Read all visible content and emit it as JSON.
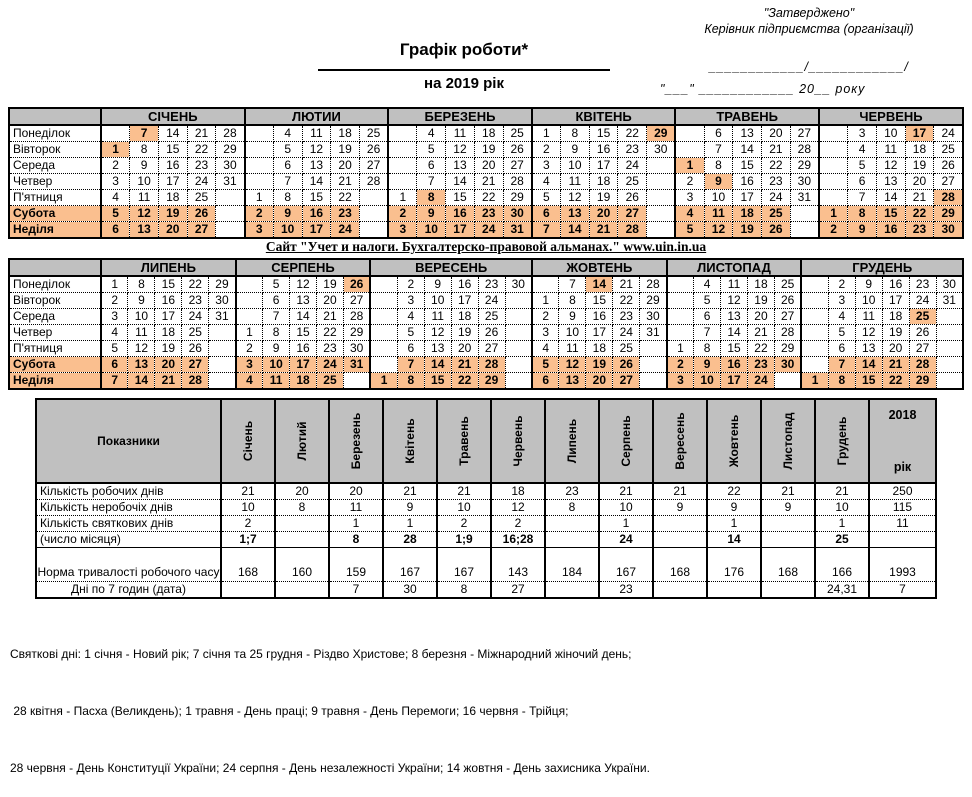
{
  "colors": {
    "header_gray": "#C0C0C0",
    "holiday_highlight": "#FABF8F"
  },
  "approval": {
    "line1": "\"Затверджено\"",
    "line2": "Керівник підприємства (організації)",
    "line3": "____________/____________/",
    "line4": "\"___\" ____________  20__ року"
  },
  "title": {
    "main": "Графік роботи*",
    "sub": "на 2019 рік"
  },
  "site_banner": "Сайт \"Учет и налоги. Бухгалтерско-правовой альманах.\" www.uin.in.ua",
  "calendar": {
    "day_labels": [
      "Понеділок",
      "Вівторок",
      "Середа",
      "Четвер",
      "П'ятниця",
      "Субота",
      "Неділя"
    ],
    "half1": {
      "months": [
        {
          "name": "СІЧЕНЬ",
          "holidays": [
            1,
            7
          ],
          "grid": [
            [
              "",
              "7",
              "14",
              "21",
              "28"
            ],
            [
              "1",
              "8",
              "15",
              "22",
              "29"
            ],
            [
              "2",
              "9",
              "16",
              "23",
              "30"
            ],
            [
              "3",
              "10",
              "17",
              "24",
              "31"
            ],
            [
              "4",
              "11",
              "18",
              "25",
              ""
            ],
            [
              "5",
              "12",
              "19",
              "26",
              ""
            ],
            [
              "6",
              "13",
              "20",
              "27",
              ""
            ]
          ]
        },
        {
          "name": "ЛЮТИИ",
          "holidays": [],
          "grid": [
            [
              "",
              "4",
              "11",
              "18",
              "25"
            ],
            [
              "",
              "5",
              "12",
              "19",
              "26"
            ],
            [
              "",
              "6",
              "13",
              "20",
              "27"
            ],
            [
              "",
              "7",
              "14",
              "21",
              "28"
            ],
            [
              "1",
              "8",
              "15",
              "22",
              ""
            ],
            [
              "2",
              "9",
              "16",
              "23",
              ""
            ],
            [
              "3",
              "10",
              "17",
              "24",
              ""
            ]
          ]
        },
        {
          "name": "БЕРЕЗЕНЬ",
          "holidays": [
            8
          ],
          "grid": [
            [
              "",
              "4",
              "11",
              "18",
              "25"
            ],
            [
              "",
              "5",
              "12",
              "19",
              "26"
            ],
            [
              "",
              "6",
              "13",
              "20",
              "27"
            ],
            [
              "",
              "7",
              "14",
              "21",
              "28"
            ],
            [
              "1",
              "8",
              "15",
              "22",
              "29"
            ],
            [
              "2",
              "9",
              "16",
              "23",
              "30"
            ],
            [
              "3",
              "10",
              "17",
              "24",
              "31"
            ]
          ]
        },
        {
          "name": "КВІТЕНЬ",
          "holidays": [
            29
          ],
          "grid": [
            [
              "1",
              "8",
              "15",
              "22",
              "29"
            ],
            [
              "2",
              "9",
              "16",
              "23",
              "30"
            ],
            [
              "3",
              "10",
              "17",
              "24",
              ""
            ],
            [
              "4",
              "11",
              "18",
              "25",
              ""
            ],
            [
              "5",
              "12",
              "19",
              "26",
              ""
            ],
            [
              "6",
              "13",
              "20",
              "27",
              ""
            ],
            [
              "7",
              "14",
              "21",
              "28",
              ""
            ]
          ]
        },
        {
          "name": "ТРАВЕНЬ",
          "holidays": [
            1,
            9
          ],
          "grid": [
            [
              "",
              "6",
              "13",
              "20",
              "27"
            ],
            [
              "",
              "7",
              "14",
              "21",
              "28"
            ],
            [
              "1",
              "8",
              "15",
              "22",
              "29"
            ],
            [
              "2",
              "9",
              "16",
              "23",
              "30"
            ],
            [
              "3",
              "10",
              "17",
              "24",
              "31"
            ],
            [
              "4",
              "11",
              "18",
              "25",
              ""
            ],
            [
              "5",
              "12",
              "19",
              "26",
              ""
            ]
          ]
        },
        {
          "name": "ЧЕРВЕНЬ",
          "holidays": [
            17,
            28
          ],
          "grid": [
            [
              "",
              "3",
              "10",
              "17",
              "24"
            ],
            [
              "",
              "4",
              "11",
              "18",
              "25"
            ],
            [
              "",
              "5",
              "12",
              "19",
              "26"
            ],
            [
              "",
              "6",
              "13",
              "20",
              "27"
            ],
            [
              "",
              "7",
              "14",
              "21",
              "28"
            ],
            [
              "1",
              "8",
              "15",
              "22",
              "29"
            ],
            [
              "2",
              "9",
              "16",
              "23",
              "30"
            ]
          ]
        }
      ]
    },
    "half2": {
      "months": [
        {
          "name": "ЛИПЕНЬ",
          "holidays": [],
          "grid": [
            [
              "1",
              "8",
              "15",
              "22",
              "29"
            ],
            [
              "2",
              "9",
              "16",
              "23",
              "30"
            ],
            [
              "3",
              "10",
              "17",
              "24",
              "31"
            ],
            [
              "4",
              "11",
              "18",
              "25",
              ""
            ],
            [
              "5",
              "12",
              "19",
              "26",
              ""
            ],
            [
              "6",
              "13",
              "20",
              "27",
              ""
            ],
            [
              "7",
              "14",
              "21",
              "28",
              ""
            ]
          ]
        },
        {
          "name": "СЕРПЕНЬ",
          "holidays": [
            26
          ],
          "grid": [
            [
              "",
              "5",
              "12",
              "19",
              "26"
            ],
            [
              "",
              "6",
              "13",
              "20",
              "27"
            ],
            [
              "",
              "7",
              "14",
              "21",
              "28"
            ],
            [
              "1",
              "8",
              "15",
              "22",
              "29"
            ],
            [
              "2",
              "9",
              "16",
              "23",
              "30"
            ],
            [
              "3",
              "10",
              "17",
              "24",
              "31"
            ],
            [
              "4",
              "11",
              "18",
              "25",
              ""
            ]
          ]
        },
        {
          "name": "ВЕРЕСЕНЬ",
          "holidays": [],
          "grid": [
            [
              "",
              "2",
              "9",
              "16",
              "23",
              "30"
            ],
            [
              "",
              "3",
              "10",
              "17",
              "24",
              ""
            ],
            [
              "",
              "4",
              "11",
              "18",
              "25",
              ""
            ],
            [
              "",
              "5",
              "12",
              "19",
              "26",
              ""
            ],
            [
              "",
              "6",
              "13",
              "20",
              "27",
              ""
            ],
            [
              "",
              "7",
              "14",
              "21",
              "28",
              ""
            ],
            [
              "1",
              "8",
              "15",
              "22",
              "29",
              ""
            ]
          ]
        },
        {
          "name": "ЖОВТЕНЬ",
          "holidays": [
            14
          ],
          "grid": [
            [
              "",
              "7",
              "14",
              "21",
              "28"
            ],
            [
              "1",
              "8",
              "15",
              "22",
              "29"
            ],
            [
              "2",
              "9",
              "16",
              "23",
              "30"
            ],
            [
              "3",
              "10",
              "17",
              "24",
              "31"
            ],
            [
              "4",
              "11",
              "18",
              "25",
              ""
            ],
            [
              "5",
              "12",
              "19",
              "26",
              ""
            ],
            [
              "6",
              "13",
              "20",
              "27",
              ""
            ]
          ]
        },
        {
          "name": "ЛИСТОПАД",
          "holidays": [],
          "grid": [
            [
              "",
              "4",
              "11",
              "18",
              "25"
            ],
            [
              "",
              "5",
              "12",
              "19",
              "26"
            ],
            [
              "",
              "6",
              "13",
              "20",
              "27"
            ],
            [
              "",
              "7",
              "14",
              "21",
              "28"
            ],
            [
              "1",
              "8",
              "15",
              "22",
              "29"
            ],
            [
              "2",
              "9",
              "16",
              "23",
              "30"
            ],
            [
              "3",
              "10",
              "17",
              "24",
              ""
            ]
          ]
        },
        {
          "name": "ГРУДЕНЬ",
          "holidays": [
            25
          ],
          "grid": [
            [
              "",
              "2",
              "9",
              "16",
              "23",
              "30"
            ],
            [
              "",
              "3",
              "10",
              "17",
              "24",
              "31"
            ],
            [
              "",
              "4",
              "11",
              "18",
              "25",
              ""
            ],
            [
              "",
              "5",
              "12",
              "19",
              "26",
              ""
            ],
            [
              "",
              "6",
              "13",
              "20",
              "27",
              ""
            ],
            [
              "",
              "7",
              "14",
              "21",
              "28",
              ""
            ],
            [
              "1",
              "8",
              "15",
              "22",
              "29",
              ""
            ]
          ]
        }
      ]
    }
  },
  "summary": {
    "corner_label": "Показники",
    "month_headers": [
      "Січень",
      "Лютий",
      "Березень",
      "Квітень",
      "Травень",
      "Червень",
      "Липень",
      "Серпень",
      "Вересень",
      "Жовтень",
      "Листопад",
      "Грудень"
    ],
    "year_header": {
      "top": "2018",
      "bottom": "рік"
    },
    "rows": [
      {
        "label": "Кількість робочих днів",
        "label_align": "left",
        "bold_values": false,
        "values": [
          "21",
          "20",
          "20",
          "21",
          "21",
          "18",
          "23",
          "21",
          "21",
          "22",
          "21",
          "21",
          "250"
        ]
      },
      {
        "label": "Кількість неробочіх днів",
        "label_align": "left",
        "bold_values": false,
        "values": [
          "10",
          "8",
          "11",
          "9",
          "10",
          "12",
          "8",
          "10",
          "9",
          "9",
          "9",
          "10",
          "115"
        ]
      },
      {
        "label": "Кількість святкових днів",
        "label_align": "left",
        "bold_values": false,
        "values": [
          "2",
          "",
          "1",
          "1",
          "2",
          "2",
          "",
          "1",
          "",
          "1",
          "",
          "1",
          "11"
        ]
      },
      {
        "label": "(число місяця)",
        "label_align": "left",
        "bold_values": true,
        "values": [
          "1;7",
          "",
          "8",
          "28",
          "1;9",
          "16;28",
          "",
          "24",
          "",
          "14",
          "",
          "25",
          ""
        ]
      },
      {
        "label": "Норма тривалості  робочого часу",
        "label_align": "center",
        "bold_values": false,
        "values": [
          "168",
          "160",
          "159",
          "167",
          "167",
          "143",
          "184",
          "167",
          "168",
          "176",
          "168",
          "166",
          "1993"
        ]
      },
      {
        "label": "Дні по 7 годин (дата)",
        "label_align": "center",
        "bold_values": false,
        "values": [
          "",
          "",
          "7",
          "30",
          "8",
          "27",
          "",
          "23",
          "",
          "",
          "",
          "24,31",
          "7"
        ]
      }
    ]
  },
  "footer": {
    "lines": [
      "Святкові дні: 1 січня - Новий рік; 7 січня та 25 грудня - Різдво Христове; 8 березня - Міжнародний жіночий день;",
      " 28 квітня - Пасха (Великдень); 1 травня - День праці; 9 травня - День Перемоги; 16 червня - Трійця;",
      "28 червня - День Конституції України; 24 серпня - День незалежності України; 14 жовтня - День захисника України."
    ]
  }
}
